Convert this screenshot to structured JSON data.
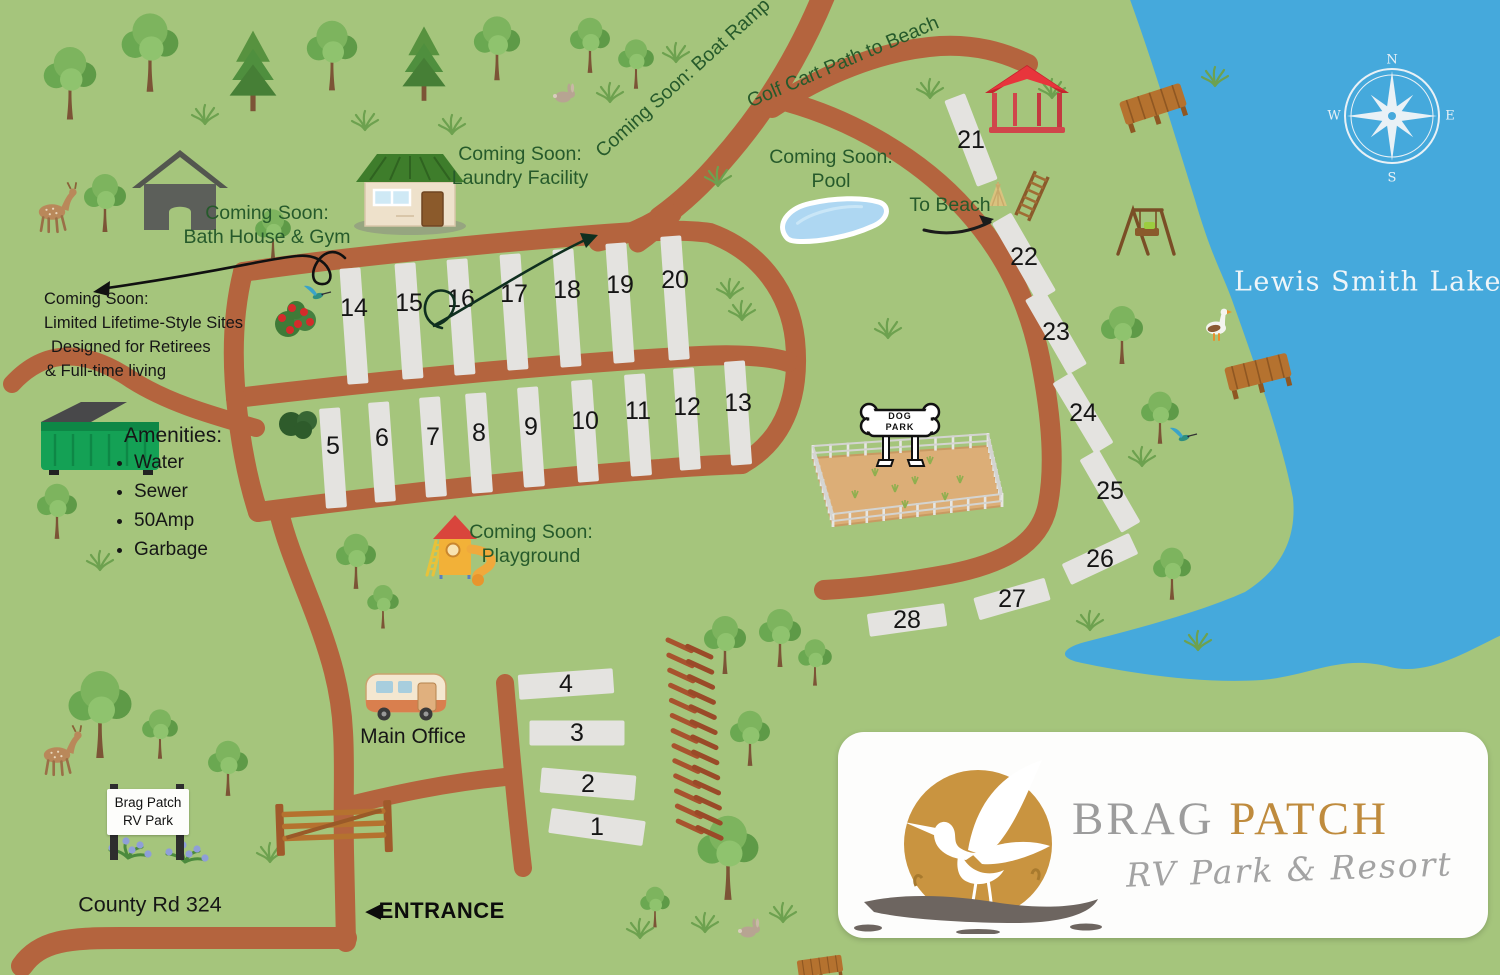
{
  "map": {
    "colors": {
      "grass": "#a5c57c",
      "road": "#b4643e",
      "water": "#45a9dc",
      "site": "#e4e3e0",
      "label_green": "#265a2b",
      "text_black": "#161616",
      "logo_gold": "#bf8b3d",
      "logo_gray": "#9c9c9c"
    },
    "lake": {
      "name": "Lewis Smith Lake",
      "path": "M 1128,-6 C 1152,60 1170,120 1195,200 C 1212,258 1222,272 1232,300 C 1252,356 1282,440 1293,498 C 1297,540 1280,570 1245,592 C 1200,612 1140,628 1085,642 C 1062,648 1056,658 1082,663 C 1130,673 1200,684 1262,680 C 1310,676 1340,654 1390,667 C 1430,677 1472,648 1506,633 L 1506,-6 Z"
    },
    "compass": {
      "n": "N",
      "e": "E",
      "s": "S",
      "w": "W",
      "x": 1392,
      "y": 116
    },
    "labels": {
      "boat_ramp": {
        "text": "Coming Soon: Boat Ramp",
        "x": 683,
        "y": 78,
        "rot": -42
      },
      "golf_cart": {
        "text": "Golf Cart Path to Beach",
        "x": 843,
        "y": 62,
        "rot": -23
      },
      "to_beach": {
        "text": "To Beach",
        "x": 950,
        "y": 205
      },
      "laundry": {
        "lines": [
          "Coming Soon:",
          "Laundry Facility"
        ],
        "x": 520,
        "y": 166
      },
      "bath": {
        "lines": [
          "Coming Soon:",
          "Bath House & Gym"
        ],
        "x": 267,
        "y": 225
      },
      "pool": {
        "lines": [
          "Coming Soon:",
          "Pool"
        ],
        "x": 831,
        "y": 169
      },
      "playground": {
        "lines": [
          "Coming Soon:",
          "Playground"
        ],
        "x": 531,
        "y": 544
      },
      "lifetime": {
        "lines": [
          "Coming Soon:",
          "Limited Lifetime-Style Sites",
          "Designed for Retirees",
          "& Full-time living"
        ],
        "x": 44,
        "y": 288
      }
    },
    "amenities": {
      "title": "Amenities:",
      "items": [
        "Water",
        "Sewer",
        "50Amp",
        "Garbage"
      ]
    },
    "signs": {
      "main_office": "Main Office",
      "county_road": "County Rd 324",
      "entrance": "ENTRANCE",
      "entrance_arrow": "◀",
      "park_sign": [
        "Brag Patch",
        "RV Park"
      ],
      "dog_park": [
        "DOG",
        "PARK"
      ]
    },
    "logo": {
      "brag": "BRAG",
      "patch": "PATCH",
      "tagline": "RV Park & Resort"
    },
    "sites": [
      {
        "n": "14",
        "x": 354,
        "y": 326,
        "w": 21,
        "h": 116,
        "r": -4,
        "ny": -18
      },
      {
        "n": "15",
        "x": 409,
        "y": 321,
        "w": 21,
        "h": 116,
        "r": -4,
        "ny": -18
      },
      {
        "n": "16",
        "x": 461,
        "y": 317,
        "w": 21,
        "h": 116,
        "r": -4,
        "ny": -18
      },
      {
        "n": "17",
        "x": 514,
        "y": 312,
        "w": 21,
        "h": 116,
        "r": -4,
        "ny": -18
      },
      {
        "n": "18",
        "x": 567,
        "y": 308,
        "w": 21,
        "h": 118,
        "r": -4,
        "ny": -18
      },
      {
        "n": "19",
        "x": 620,
        "y": 303,
        "w": 21,
        "h": 120,
        "r": -4,
        "ny": -18
      },
      {
        "n": "20",
        "x": 675,
        "y": 298,
        "w": 21,
        "h": 124,
        "r": -4,
        "ny": -18
      },
      {
        "n": "5",
        "x": 333,
        "y": 458,
        "w": 21,
        "h": 100,
        "r": -4,
        "ny": -12
      },
      {
        "n": "6",
        "x": 382,
        "y": 452,
        "w": 21,
        "h": 100,
        "r": -4,
        "ny": -14
      },
      {
        "n": "7",
        "x": 433,
        "y": 447,
        "w": 21,
        "h": 100,
        "r": -4,
        "ny": -10
      },
      {
        "n": "8",
        "x": 479,
        "y": 443,
        "w": 21,
        "h": 100,
        "r": -4,
        "ny": -10
      },
      {
        "n": "9",
        "x": 531,
        "y": 437,
        "w": 21,
        "h": 100,
        "r": -4,
        "ny": -10
      },
      {
        "n": "10",
        "x": 585,
        "y": 431,
        "w": 21,
        "h": 102,
        "r": -4,
        "ny": -10
      },
      {
        "n": "11",
        "x": 638,
        "y": 425,
        "w": 21,
        "h": 102,
        "r": -4,
        "ny": -14
      },
      {
        "n": "12",
        "x": 687,
        "y": 419,
        "w": 21,
        "h": 102,
        "r": -4,
        "ny": -12
      },
      {
        "n": "13",
        "x": 738,
        "y": 413,
        "w": 21,
        "h": 104,
        "r": -4,
        "ny": -10
      },
      {
        "n": "21",
        "x": 971,
        "y": 140,
        "w": 22,
        "h": 92,
        "r": -21,
        "ny": 0
      },
      {
        "n": "22",
        "x": 1024,
        "y": 257,
        "w": 22,
        "h": 90,
        "r": -30,
        "ny": 0
      },
      {
        "n": "23",
        "x": 1056,
        "y": 332,
        "w": 22,
        "h": 86,
        "r": -30,
        "ny": 0
      },
      {
        "n": "24",
        "x": 1083,
        "y": 413,
        "w": 22,
        "h": 82,
        "r": -31,
        "ny": 0
      },
      {
        "n": "25",
        "x": 1110,
        "y": 491,
        "w": 22,
        "h": 84,
        "r": -30,
        "ny": 0
      },
      {
        "n": "26",
        "x": 1100,
        "y": 559,
        "w": 74,
        "h": 23,
        "r": -25,
        "ny": 0
      },
      {
        "n": "27",
        "x": 1012,
        "y": 599,
        "w": 74,
        "h": 23,
        "r": -16,
        "ny": 0
      },
      {
        "n": "28",
        "x": 907,
        "y": 620,
        "w": 78,
        "h": 23,
        "r": -8,
        "ny": 0
      },
      {
        "n": "4",
        "x": 566,
        "y": 684,
        "w": 95,
        "h": 25,
        "r": -4,
        "ny": 0
      },
      {
        "n": "3",
        "x": 577,
        "y": 733,
        "w": 95,
        "h": 25,
        "r": 0,
        "ny": 0
      },
      {
        "n": "2",
        "x": 588,
        "y": 784,
        "w": 95,
        "h": 25,
        "r": 5,
        "ny": 0
      },
      {
        "n": "1",
        "x": 597,
        "y": 827,
        "w": 95,
        "h": 25,
        "r": 8,
        "ny": 0
      }
    ],
    "roads": [
      {
        "name": "county-road",
        "w": 22,
        "d": "M 22,966 C 40,940 70,938 120,938 L 346,938"
      },
      {
        "name": "entrance-road",
        "w": 20,
        "d": "M 346,942 L 344,852 C 343,800 345,762 343,732 C 341,690 331,655 312,606 C 296,565 285,538 279,512"
      },
      {
        "name": "office-branch",
        "w": 18,
        "d": "M 346,806 C 395,794 445,783 505,777"
      },
      {
        "name": "sites-1-4-road",
        "w": 18,
        "d": "M 505,683 C 509,730 515,800 523,868"
      },
      {
        "name": "dumpster-spur",
        "w": 18,
        "d": "M 12,384 C 45,348 85,348 132,380 C 170,404 215,416 256,428"
      },
      {
        "name": "boat-ramp-road",
        "w": 23,
        "d": "M 826,-10 C 800,55 766,110 722,160 C 700,186 678,205 660,218"
      },
      {
        "name": "fork-a",
        "w": 19,
        "d": "M 668,212 C 645,228 618,238 598,242"
      },
      {
        "name": "fork-b",
        "w": 19,
        "d": "M 672,214 C 658,228 648,236 638,243"
      },
      {
        "name": "golf-cart-road",
        "w": 20,
        "d": "M 772,108 C 820,76 880,50 940,46 C 975,44 1003,52 1028,64"
      },
      {
        "name": "beach-road",
        "w": 20,
        "d": "M 788,102 C 852,120 920,158 966,210 C 1004,252 1028,300 1040,358 C 1050,408 1056,462 1048,504 C 1040,546 1000,564 950,574 C 906,582 862,588 824,590"
      },
      {
        "name": "loop-top",
        "w": 20,
        "d": "M 243,272 C 340,257 520,240 620,233 C 660,230 690,230 710,233 C 762,252 790,295 795,340 C 800,390 788,438 742,464"
      },
      {
        "name": "loop-mid",
        "w": 20,
        "d": "M 236,398 C 380,381 560,363 700,356 C 735,354 770,356 788,362"
      },
      {
        "name": "loop-bottom",
        "w": 20,
        "d": "M 258,512 C 380,496 540,478 660,469 C 690,466 720,465 742,464"
      },
      {
        "name": "loop-left-top",
        "w": 20,
        "d": "M 243,272 C 233,312 232,356 236,398"
      },
      {
        "name": "loop-left-bottom",
        "w": 20,
        "d": "M 236,398 C 240,440 247,478 258,512"
      }
    ],
    "decor": [
      {
        "t": "tree",
        "x": 70,
        "y": 92,
        "s": 1.25
      },
      {
        "t": "tree",
        "x": 150,
        "y": 62,
        "s": 1.35
      },
      {
        "t": "pine",
        "x": 253,
        "y": 80,
        "s": 1.3
      },
      {
        "t": "tree",
        "x": 332,
        "y": 64,
        "s": 1.2
      },
      {
        "t": "pine",
        "x": 424,
        "y": 72,
        "s": 1.2
      },
      {
        "t": "tree",
        "x": 497,
        "y": 56,
        "s": 1.1
      },
      {
        "t": "tree",
        "x": 590,
        "y": 52,
        "s": 0.95
      },
      {
        "t": "tree",
        "x": 636,
        "y": 70,
        "s": 0.85
      },
      {
        "t": "tree",
        "x": 105,
        "y": 210,
        "s": 1.0
      },
      {
        "t": "tree",
        "x": 273,
        "y": 240,
        "s": 0.85
      },
      {
        "t": "tree",
        "x": 57,
        "y": 518,
        "s": 0.95
      },
      {
        "t": "tree",
        "x": 100,
        "y": 725,
        "s": 1.5
      },
      {
        "t": "tree",
        "x": 160,
        "y": 740,
        "s": 0.85
      },
      {
        "t": "tree",
        "x": 228,
        "y": 775,
        "s": 0.95
      },
      {
        "t": "tree",
        "x": 356,
        "y": 568,
        "s": 0.95
      },
      {
        "t": "tree",
        "x": 383,
        "y": 612,
        "s": 0.75
      },
      {
        "t": "tree",
        "x": 725,
        "y": 652,
        "s": 1.0
      },
      {
        "t": "tree",
        "x": 780,
        "y": 645,
        "s": 1.0
      },
      {
        "t": "tree",
        "x": 815,
        "y": 668,
        "s": 0.8
      },
      {
        "t": "tree",
        "x": 750,
        "y": 745,
        "s": 0.95
      },
      {
        "t": "tree",
        "x": 728,
        "y": 868,
        "s": 1.45
      },
      {
        "t": "tree",
        "x": 655,
        "y": 912,
        "s": 0.7
      },
      {
        "t": "tree",
        "x": 1122,
        "y": 342,
        "s": 1.0
      },
      {
        "t": "tree",
        "x": 1160,
        "y": 424,
        "s": 0.9
      },
      {
        "t": "tree",
        "x": 1172,
        "y": 580,
        "s": 0.9
      },
      {
        "t": "grass",
        "x": 205,
        "y": 124
      },
      {
        "t": "grass",
        "x": 365,
        "y": 130
      },
      {
        "t": "grass",
        "x": 452,
        "y": 134
      },
      {
        "t": "grass",
        "x": 610,
        "y": 102
      },
      {
        "t": "grass",
        "x": 676,
        "y": 62
      },
      {
        "t": "grass",
        "x": 930,
        "y": 98
      },
      {
        "t": "grass",
        "x": 1052,
        "y": 98
      },
      {
        "t": "grass",
        "x": 1215,
        "y": 86
      },
      {
        "t": "grass",
        "x": 718,
        "y": 186
      },
      {
        "t": "grass",
        "x": 730,
        "y": 298
      },
      {
        "t": "grass",
        "x": 742,
        "y": 320
      },
      {
        "t": "grass",
        "x": 888,
        "y": 338
      },
      {
        "t": "grass",
        "x": 100,
        "y": 570
      },
      {
        "t": "grass",
        "x": 1142,
        "y": 466
      },
      {
        "t": "grass",
        "x": 1090,
        "y": 630
      },
      {
        "t": "grass",
        "x": 1198,
        "y": 650
      },
      {
        "t": "grass",
        "x": 640,
        "y": 938
      },
      {
        "t": "grass",
        "x": 705,
        "y": 932
      },
      {
        "t": "grass",
        "x": 783,
        "y": 922
      },
      {
        "t": "grass",
        "x": 270,
        "y": 862
      },
      {
        "t": "bush",
        "x": 300,
        "y": 424
      },
      {
        "t": "roses",
        "x": 296,
        "y": 320
      },
      {
        "t": "flowers",
        "x": 128,
        "y": 858
      },
      {
        "t": "flowers",
        "x": 185,
        "y": 862
      },
      {
        "t": "deer",
        "x": 52,
        "y": 212,
        "s": 1.1
      },
      {
        "t": "deer",
        "x": 57,
        "y": 755,
        "s": 1.1
      },
      {
        "t": "rabbit",
        "x": 563,
        "y": 97
      },
      {
        "t": "rabbit",
        "x": 748,
        "y": 932
      },
      {
        "t": "goose",
        "x": 1216,
        "y": 328
      },
      {
        "t": "hummingbird",
        "x": 318,
        "y": 296
      },
      {
        "t": "hummingbird",
        "x": 1184,
        "y": 438
      },
      {
        "t": "pavilion",
        "x": 1027,
        "y": 99
      },
      {
        "t": "dock",
        "x": 1153,
        "y": 104,
        "r": -18
      },
      {
        "t": "dock",
        "x": 1258,
        "y": 372,
        "r": -14
      },
      {
        "t": "dock",
        "x": 820,
        "y": 966,
        "s": 0.7,
        "r": -8
      },
      {
        "t": "swing",
        "x": 1146,
        "y": 230
      },
      {
        "t": "ladder",
        "x": 1032,
        "y": 196,
        "r": 24
      },
      {
        "t": "hay",
        "x": 998,
        "y": 196
      },
      {
        "t": "dumpster",
        "x": 103,
        "y": 448
      },
      {
        "t": "gate",
        "x": 334,
        "y": 826
      },
      {
        "t": "railfence",
        "x": 668,
        "y": 640,
        "r": 4
      },
      {
        "t": "signposts",
        "x": 148,
        "y": 820
      },
      {
        "t": "camper",
        "x": 406,
        "y": 696
      },
      {
        "t": "laundry",
        "x": 410,
        "y": 190
      },
      {
        "t": "bathhouse",
        "x": 180,
        "y": 190
      },
      {
        "t": "playground",
        "x": 461,
        "y": 551
      },
      {
        "t": "pool",
        "x": 833,
        "y": 216,
        "r": -18
      },
      {
        "t": "dogpark",
        "x": 905,
        "y": 478
      },
      {
        "t": "arrow",
        "x": 960,
        "y": 223
      },
      {
        "t": "curl_left",
        "x": 205,
        "y": 268
      },
      {
        "t": "curl_golf",
        "x": 497,
        "y": 280
      }
    ]
  }
}
